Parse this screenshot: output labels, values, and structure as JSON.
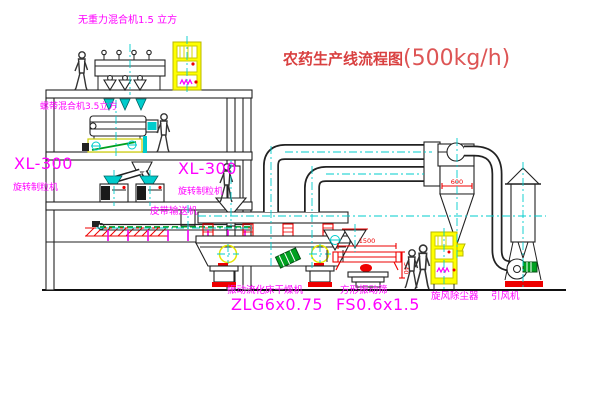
{
  "title": {
    "name": "农药生产线流程图",
    "capacity": "(500kg/h)"
  },
  "equipment_labels": {
    "gravity_mixer": "无重力混合机1.5 立方",
    "second_mixer": "螺带混合机3.5立方",
    "granulator_left_model": "XL-300",
    "granulator_left_name": "旋转制粒机",
    "granulator_right_model": "XL-300",
    "granulator_right_name": "旋转制粒机",
    "belt_conveyor": "皮带输送机",
    "dryer_name": "振动流化床干燥机",
    "dryer_model": "ZLG6x0.75",
    "sieve_name": "方形振动筛",
    "sieve_model": "FS0.6x1.5",
    "cyclone_name": "旋风除尘器",
    "fan_name": "引风机"
  },
  "dimensions": {
    "cyclone_diameter": "600",
    "sieve_length": "1500",
    "sieve_height": "540"
  },
  "colors": {
    "label_magenta": "#ff00ff",
    "title_red": "#d94040",
    "line_dark": "#222222",
    "centerline_cyan": "#00cccc",
    "accent_yellow": "#ffff00",
    "accent_red": "#ee0000",
    "accent_green": "#00a020"
  }
}
